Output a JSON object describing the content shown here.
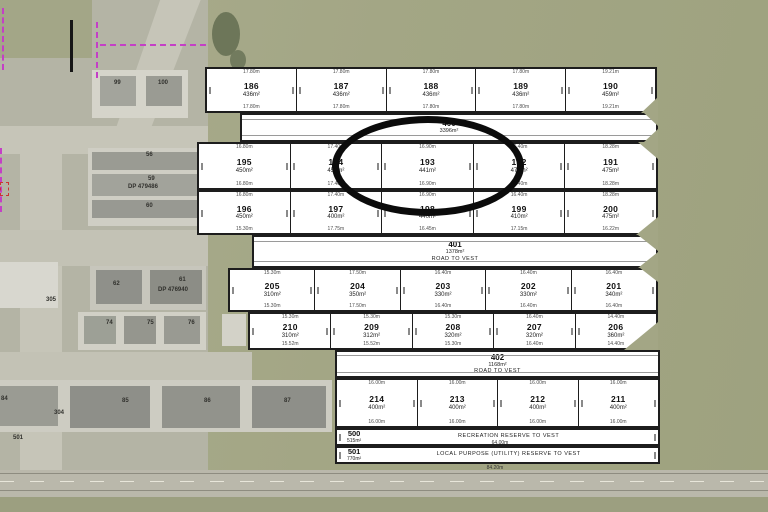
{
  "title": "Subdivision scheme plan over aerial photo",
  "annotation": {
    "type": "ellipse-highlight",
    "highlighted_lot": "193",
    "color": "#0b0b0b"
  },
  "plan": {
    "rows": [
      {
        "cells": [
          {
            "id": "186",
            "area": "436m²",
            "dim_top": "17.80m",
            "dim_bottom": "17.80m"
          },
          {
            "id": "187",
            "area": "436m²",
            "dim_top": "17.80m",
            "dim_bottom": "17.80m"
          },
          {
            "id": "188",
            "area": "436m²",
            "dim_top": "17.80m",
            "dim_bottom": "17.80m"
          },
          {
            "id": "189",
            "area": "436m²",
            "dim_top": "17.80m",
            "dim_bottom": "17.80m"
          },
          {
            "id": "190",
            "area": "459m²",
            "dim_top": "19.21m",
            "dim_bottom": "19.21m"
          }
        ]
      },
      {
        "cells": [
          {
            "id": "195",
            "area": "450m²",
            "dim_top": "16.80m",
            "dim_bottom": "16.80m"
          },
          {
            "id": "194",
            "area": "450m²",
            "dim_top": "17.40m",
            "dim_bottom": "17.40m"
          },
          {
            "id": "193",
            "area": "441m²",
            "dim_top": "16.90m",
            "dim_bottom": "16.90m"
          },
          {
            "id": "192",
            "area": "470m²",
            "dim_top": "16.40m",
            "dim_bottom": "16.40m"
          },
          {
            "id": "191",
            "area": "475m²",
            "dim_top": "18.28m",
            "dim_bottom": "18.28m"
          }
        ]
      },
      {
        "cells": [
          {
            "id": "196",
            "area": "450m²",
            "dim_top": "16.80m",
            "dim_bottom": "15.30m"
          },
          {
            "id": "197",
            "area": "400m²",
            "dim_top": "17.40m",
            "dim_bottom": "17.75m"
          },
          {
            "id": "198",
            "area": "440m²",
            "dim_top": "16.90m",
            "dim_bottom": "16.45m"
          },
          {
            "id": "199",
            "area": "410m²",
            "dim_top": "16.40m",
            "dim_bottom": "17.15m"
          },
          {
            "id": "200",
            "area": "475m²",
            "dim_top": "18.28m",
            "dim_bottom": "16.22m"
          }
        ]
      },
      {
        "cells": [
          {
            "id": "205",
            "area": "310m²",
            "dim_top": "15.30m",
            "dim_bottom": "15.30m"
          },
          {
            "id": "204",
            "area": "350m²",
            "dim_top": "17.50m",
            "dim_bottom": "17.50m"
          },
          {
            "id": "203",
            "area": "330m²",
            "dim_top": "16.40m",
            "dim_bottom": "16.40m"
          },
          {
            "id": "202",
            "area": "330m²",
            "dim_top": "16.40m",
            "dim_bottom": "16.40m"
          },
          {
            "id": "201",
            "area": "340m²",
            "dim_top": "16.40m",
            "dim_bottom": "16.40m"
          }
        ]
      },
      {
        "cells": [
          {
            "id": "210",
            "area": "310m²",
            "dim_top": "15.30m",
            "dim_bottom": "15.52m"
          },
          {
            "id": "209",
            "area": "312m²",
            "dim_top": "15.30m",
            "dim_bottom": "15.52m"
          },
          {
            "id": "208",
            "area": "320m²",
            "dim_top": "15.30m",
            "dim_bottom": "15.30m"
          },
          {
            "id": "207",
            "area": "320m²",
            "dim_top": "16.40m",
            "dim_bottom": "16.40m"
          },
          {
            "id": "206",
            "area": "360m²",
            "dim_top": "14.40m",
            "dim_bottom": "14.40m"
          }
        ]
      },
      {
        "cells": [
          {
            "id": "214",
            "area": "400m²",
            "dim_top": "16.00m",
            "dim_bottom": "16.00m"
          },
          {
            "id": "213",
            "area": "400m²",
            "dim_top": "16.00m",
            "dim_bottom": "16.00m"
          },
          {
            "id": "212",
            "area": "400m²",
            "dim_top": "16.00m",
            "dim_bottom": "16.00m"
          },
          {
            "id": "211",
            "area": "400m²",
            "dim_top": "16.00m",
            "dim_bottom": "16.00m"
          }
        ]
      }
    ],
    "strips": [
      {
        "id": "400",
        "area": "3396m²",
        "note": ""
      },
      {
        "id": "401",
        "area": "1378m²",
        "note": "ROAD TO VEST"
      },
      {
        "id": "402",
        "area": "1168m²",
        "note": "ROAD TO VEST"
      },
      {
        "id": "500",
        "area": "515m²",
        "note": "RECREATION RESERVE TO VEST",
        "dim": "64.00m"
      },
      {
        "id": "501",
        "area": "770m²",
        "note": "LOCAL PURPOSE (UTILITY) RESERVE TO VEST",
        "dim": "84.20m"
      }
    ]
  },
  "aerial": {
    "labels": [
      "99",
      "100",
      "56",
      "59",
      "DP 479486",
      "60",
      "62",
      "61",
      "DP 476940",
      "305",
      "74",
      "75",
      "76",
      "84",
      "85",
      "86",
      "87",
      "304",
      "501"
    ]
  },
  "colors": {
    "grass": "#a5a88a",
    "urban": "#b4b4a5",
    "road": "#c6c5b8",
    "roof": "#95968e",
    "plan_line": "#1d1d1d",
    "highlight": "#0b0b0b",
    "boundary_dashed": "#c43fc6"
  }
}
